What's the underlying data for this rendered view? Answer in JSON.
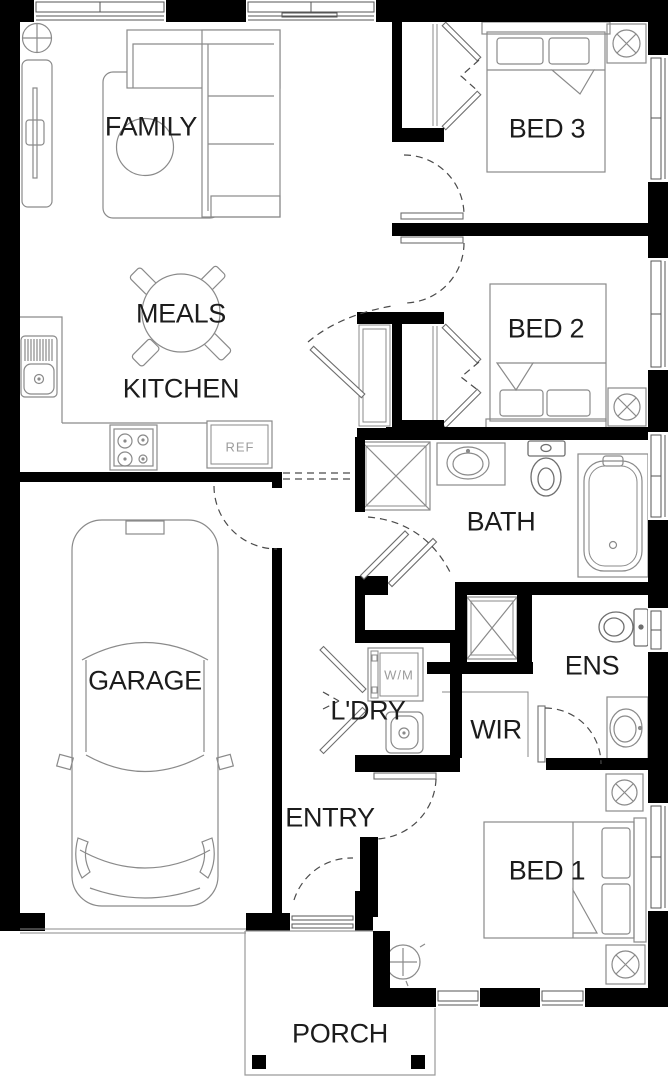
{
  "rooms": {
    "family": "FAMILY",
    "meals": "MEALS",
    "kitchen": "KITCHEN",
    "bed3": "BED 3",
    "bed2": "BED 2",
    "bath": "BATH",
    "garage": "GARAGE",
    "ens": "ENS",
    "ldry": "L'DRY",
    "wir": "WIR",
    "entry": "ENTRY",
    "bed1": "BED 1",
    "porch": "PORCH"
  },
  "appliances": {
    "fridge": "REF",
    "washer": "W/M"
  },
  "colors": {
    "wall": "#000000",
    "furniture": "#8a8a8a",
    "fixture": "#6f6f6f",
    "label": "#1c1c1c",
    "appliance_label": "#9c9c9c",
    "door_dash": "#4a4a4a",
    "background": "#ffffff"
  }
}
